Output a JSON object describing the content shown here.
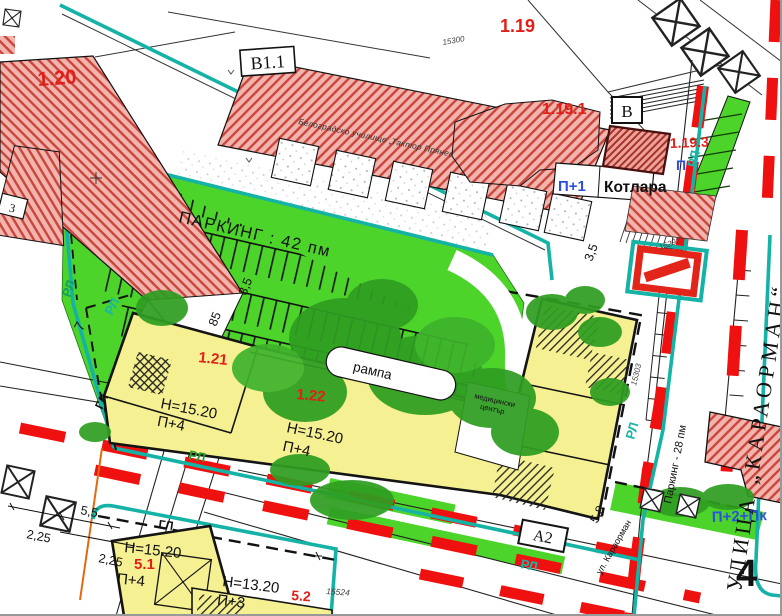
{
  "map": {
    "title": "Urban regulation plan",
    "parcels": {
      "p120": "1.20",
      "p119": "1.19",
      "p1191": "1.19.1",
      "p1193": "1.19.3",
      "p121": "1.21",
      "p122": "1.22",
      "p51": "5.1",
      "p52": "5.2"
    },
    "buildings": {
      "b11": "В1.1",
      "b": "В",
      "a2": "А2",
      "kotlara": "Котлара",
      "school": "Белоградско училище „Тактор Прянев“",
      "med1": "медицински",
      "med2": "център"
    },
    "zoning": {
      "h1520": "Н=15.20",
      "h1320": "Н=13.20",
      "p4": "П+4",
      "p3": "П+3",
      "p1": "П+1",
      "p": "П",
      "p2pk": "П+2+Пк"
    },
    "parking": {
      "lot": "ПАРКИНГ : 42 пм",
      "street": "Паркинг - 28 пм",
      "ramp": "рампа"
    },
    "streets": {
      "karaorman": "УЛИЦА „КАРАОРМАН“",
      "karaorman_small": "ул. Караорман"
    },
    "reg_lines": {
      "rl": "РЛ",
      "gl": "ГЛ"
    },
    "dims": {
      "d225": "2,25",
      "d55": "5,5",
      "d35": "3,5",
      "d85": "85",
      "d58": "5,8",
      "d7": "7"
    },
    "elev": {
      "e1": "15300",
      "e2": "15292",
      "e3": "15303",
      "e4": "15524"
    },
    "block": "4",
    "partial": "3",
    "colors": {
      "parcel_red": "#e31e18",
      "zone_blue": "#2b50dd",
      "reg_teal": "#14b3a6",
      "green": "#4cd42b",
      "dark_green": "#2f9e22",
      "yellow": "#f5f092",
      "hatch_red": "#c8463c",
      "dash_red": "#ef1010"
    }
  }
}
